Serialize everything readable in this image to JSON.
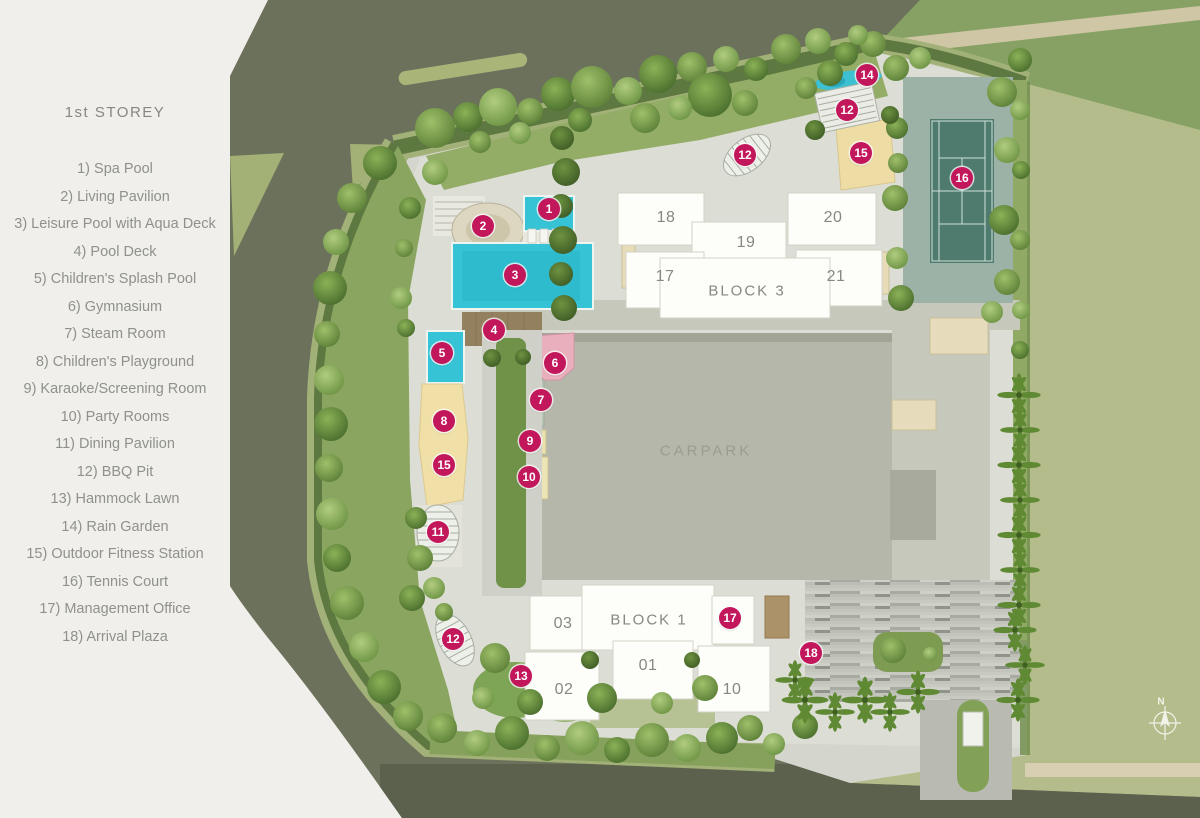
{
  "sidebar": {
    "title": "1st STOREY",
    "items": [
      "1) Spa Pool",
      "2) Living Pavilion",
      "3) Leisure Pool with Aqua Deck",
      "4) Pool Deck",
      "5) Children's Splash Pool",
      "6) Gymnasium",
      "7) Steam Room",
      "8) Children's Playground",
      "9) Karaoke/Screening Room",
      "10) Party Rooms",
      "11) Dining Pavilion",
      "12) BBQ Pit",
      "13) Hammock Lawn",
      "14) Rain Garden",
      "15) Outdoor Fitness Station",
      "16) Tennis Court",
      "17) Management Office",
      "18) Arrival Plaza"
    ]
  },
  "plan": {
    "carpark_label": "CARPARK",
    "block3_label": "BLOCK 3",
    "block1_label": "BLOCK 1",
    "compass_north": "N",
    "block3_units": [
      "18",
      "19",
      "20",
      "17",
      "21"
    ],
    "block1_units": [
      "03",
      "01",
      "02",
      "10"
    ],
    "markers": [
      {
        "num": "1",
        "amenity": "Spa Pool"
      },
      {
        "num": "2",
        "amenity": "Living Pavilion"
      },
      {
        "num": "3",
        "amenity": "Leisure Pool with Aqua Deck"
      },
      {
        "num": "4",
        "amenity": "Pool Deck"
      },
      {
        "num": "5",
        "amenity": "Children's Splash Pool"
      },
      {
        "num": "6",
        "amenity": "Gymnasium"
      },
      {
        "num": "7",
        "amenity": "Steam Room"
      },
      {
        "num": "8",
        "amenity": "Children's Playground"
      },
      {
        "num": "9",
        "amenity": "Karaoke/Screening Room"
      },
      {
        "num": "10",
        "amenity": "Party Rooms"
      },
      {
        "num": "11",
        "amenity": "Dining Pavilion"
      },
      {
        "num": "12",
        "amenity": "BBQ Pit"
      },
      {
        "num": "12",
        "amenity": "BBQ Pit"
      },
      {
        "num": "12",
        "amenity": "BBQ Pit"
      },
      {
        "num": "13",
        "amenity": "Hammock Lawn"
      },
      {
        "num": "14",
        "amenity": "Rain Garden"
      },
      {
        "num": "15",
        "amenity": "Outdoor Fitness Station"
      },
      {
        "num": "15",
        "amenity": "Outdoor Fitness Station"
      },
      {
        "num": "16",
        "amenity": "Tennis Court"
      },
      {
        "num": "17",
        "amenity": "Management Office"
      },
      {
        "num": "18",
        "amenity": "Arrival Plaza"
      }
    ],
    "colors": {
      "marker": "#c2175b",
      "pool": "#35c3d5",
      "road": "#6c715c",
      "field": "#b4bc8b",
      "tennis_court": "#4f7b6e",
      "hardscape": "#dcddd5",
      "building": "#fdfdf9",
      "sand": "#f0dfa6",
      "gym_pink": "#e9afbc"
    }
  }
}
